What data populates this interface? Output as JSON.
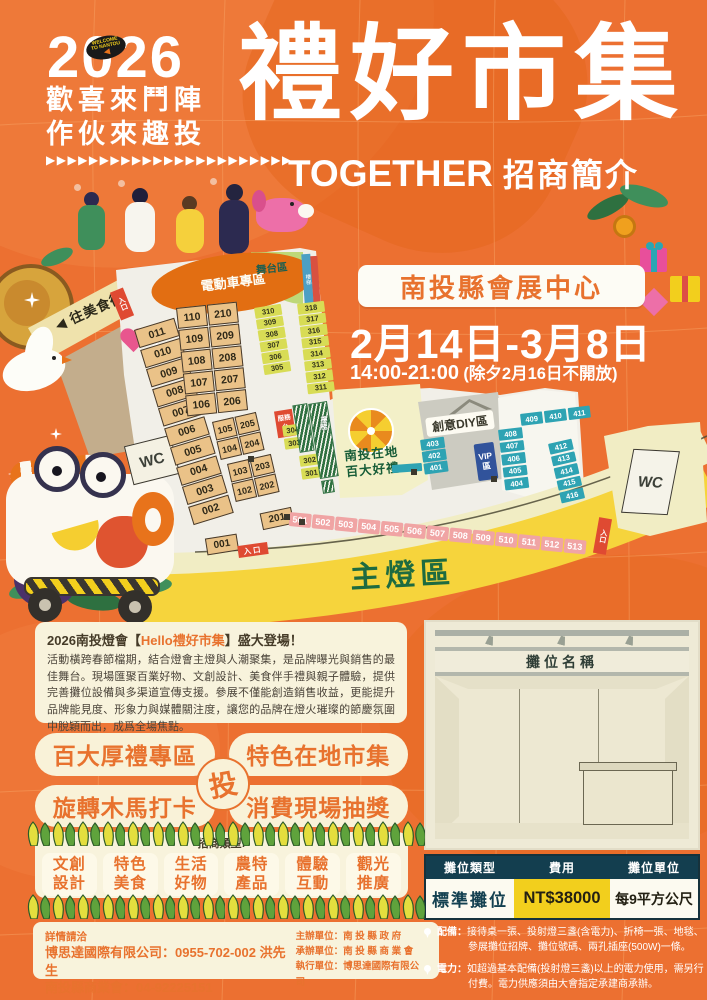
{
  "header": {
    "year": "2026",
    "badge": {
      "l1": "WELCOME",
      "l2": "TO NANTOU",
      "arrow": "◀"
    },
    "slogan1": "歡喜來鬥陣",
    "slogan2": "作伙來趣投",
    "arrows": "▶▶▶▶▶▶▶▶▶▶▶▶▶▶▶▶▶▶▶▶▶▶▶",
    "title": "禮好市集",
    "subtitle_en": "TOGETHER",
    "subtitle_zh": "招商簡介"
  },
  "venue": {
    "name": "南投縣會展中心",
    "dates": "2月14日-3月8日",
    "hours": "14:00-21:00",
    "hours_note": "(除夕2月16日不開放)"
  },
  "map": {
    "labels": {
      "ev_zone": "電動車專區",
      "stage": "舞台區",
      "stage_side": "樓梯",
      "food_street": "◀ 往美食街",
      "entrance_left": "入口",
      "entrance_bottom": "入口",
      "entrance_right": "入口",
      "wc_left": "WC",
      "wc_right": "WC",
      "service_desk": "服務台",
      "stairs": "樓梯",
      "local_line1": "南投在地",
      "local_line2": "百大好禮",
      "diy": "創意DIY區",
      "vip": "VIP區",
      "main_lantern": "主燈區"
    },
    "left_column": [
      "011",
      "010",
      "009",
      "008",
      "007",
      "006",
      "005",
      "004",
      "003",
      "002"
    ],
    "grid1": [
      [
        "110",
        "210"
      ],
      [
        "109",
        "209"
      ],
      [
        "108",
        "208"
      ],
      [
        "107",
        "207"
      ],
      [
        "106",
        "206"
      ]
    ],
    "grid2": [
      [
        "105",
        "205"
      ],
      [
        "104",
        "204"
      ]
    ],
    "grid3": [
      [
        "103",
        "203"
      ],
      [
        "102",
        "202"
      ]
    ],
    "booth_201": "201",
    "booth_001": "001",
    "yellow_a": [
      "310",
      "309",
      "308",
      "307",
      "306",
      "305"
    ],
    "yellow_b": [
      "318",
      "317",
      "316",
      "315",
      "314",
      "313",
      "312",
      "311"
    ],
    "yellow_c": [
      "304",
      "303"
    ],
    "yellow_d": [
      "302",
      "301"
    ],
    "teal_a": [
      "403",
      "402",
      "401"
    ],
    "teal_b": [
      "408",
      "407",
      "406",
      "405",
      "404"
    ],
    "teal_row": [
      "409",
      "410",
      "411"
    ],
    "teal_c": [
      "412",
      "413",
      "414",
      "415",
      "416"
    ],
    "pink_row": [
      "501",
      "502",
      "503",
      "504",
      "505",
      "506",
      "507",
      "508",
      "509",
      "510",
      "511",
      "512",
      "513"
    ]
  },
  "intro": {
    "title_pre": "2026南投燈會【",
    "title_highlight": "Hello禮好市集",
    "title_post": "】盛大登場！",
    "body": "活動橫跨春節檔期，結合燈會主燈與人潮聚集，是品牌曝光與銷售的最佳舞台。現場匯聚百業好物、文創設計、美食伴手禮與親子體驗，提供完善攤位設備與多渠道宣傳支援。參展不僅能創造銷售收益，更能提升品牌能見度、形象力與媒體關注度，讓您的品牌在燈火璀璨的節慶氛圍中脫穎而出，成爲全場焦點。"
  },
  "features": {
    "badges": [
      "百大厚禮專區",
      "特色在地市集",
      "旋轉木馬打卡",
      "消費現場抽獎"
    ],
    "center": "投"
  },
  "categories": {
    "heading": "招商類型:",
    "items": [
      [
        "文創",
        "設計"
      ],
      [
        "特色",
        "美食"
      ],
      [
        "生活",
        "好物"
      ],
      [
        "農特",
        "產品"
      ],
      [
        "體驗",
        "互動"
      ],
      [
        "觀光",
        "推廣"
      ]
    ]
  },
  "contact": {
    "heading": "詳情請洽",
    "line1": "博思達國際有限公司：0955-702-002 洪先生",
    "line2": "南投縣商業會：04-92225151"
  },
  "organizers": {
    "host": "主辦單位：南 投 縣 政 府",
    "co": "承辦單位：南 投 縣 商 業 會",
    "exec": "執行單位：博思達國際有限公司"
  },
  "booth_panel": {
    "sign": "攤位名稱",
    "table_headers": [
      "攤位類型",
      "費用",
      "攤位單位"
    ],
    "row": {
      "type": "標準攤位",
      "price": "NT$38000",
      "unit": "每9平方公尺"
    },
    "notes": [
      {
        "label": "配備：",
        "text": "接待桌一張、投射燈三盞(含電力)、折椅一張、地毯、參展攤位招牌、攤位號碼、兩孔插座(500W)一條。"
      },
      {
        "label": "電力：",
        "text": "如超過基本配備(投射燈三盞)以上的電力使用，需另行付費。電力供應須由大會指定承建商承辦。"
      }
    ]
  },
  "colors": {
    "background": "#EC7031",
    "accent_orange": "#E8722E",
    "cream": "#F8F3DC",
    "booth_beige": "#EAC288",
    "booth_yellow": "#D8DC55",
    "booth_teal": "#2EA3B3",
    "booth_pink": "#F0A4A4",
    "price_yellow": "#F2CF1D",
    "table_header": "#133E4F"
  }
}
